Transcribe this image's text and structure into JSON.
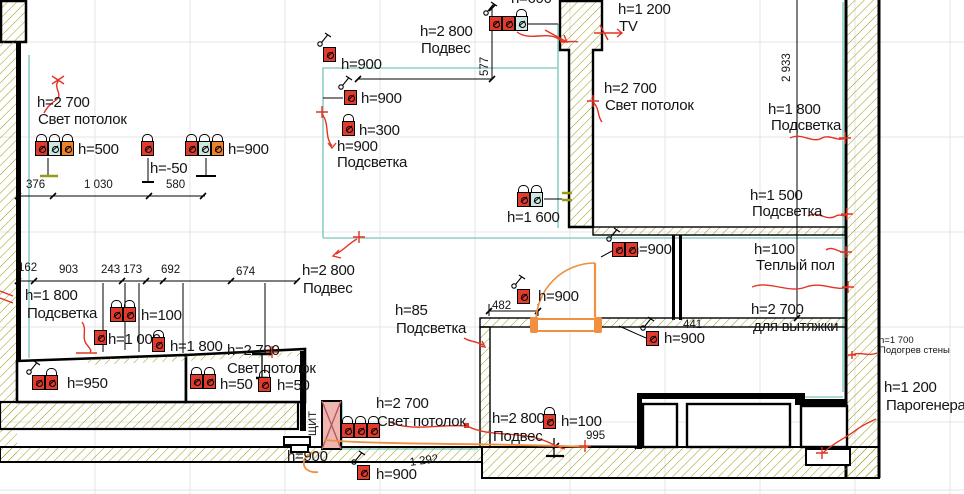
{
  "drawing_type": "electrical outlet height plan fragment",
  "colors": {
    "outletRed": "#e23b2e",
    "cellTeal": "#cfe7e1",
    "cellOrange": "#ee8227",
    "tealLine": "#8ecfc6",
    "hatch": "#9a9b12",
    "markupRed": "#e23323",
    "doorOrange": "#ef8f3f",
    "panelPink": "#efb6b0",
    "panelX": "#b2595c",
    "grid": "#e4e4e4",
    "ink": "#151515"
  },
  "annotations": {
    "labels": [
      {
        "id": "height-ceiling-light-topleft",
        "text": "h=2 700",
        "x": 37,
        "y": 95
      },
      {
        "id": "name-ceiling-light-topleft",
        "text": "Свет потолок",
        "x": 38,
        "y": 112
      },
      {
        "id": "height-500",
        "text": "h=500",
        "x": 78,
        "y": 142
      },
      {
        "id": "height-minus-50",
        "text": "h=-50",
        "x": 150,
        "y": 161
      },
      {
        "id": "height-900-topleft",
        "text": "h=900",
        "x": 228,
        "y": 142
      },
      {
        "id": "dim-376",
        "text": "376",
        "x": 26,
        "y": 179,
        "fs": 11.5
      },
      {
        "id": "dim-1030",
        "text": "1 030",
        "x": 84,
        "y": 179,
        "fs": 11.5
      },
      {
        "id": "dim-580",
        "text": "580",
        "x": 166,
        "y": 179,
        "fs": 11.5
      },
      {
        "id": "height-900-a",
        "text": "h=900",
        "x": 341,
        "y": 57
      },
      {
        "id": "height-900-b",
        "text": "h=900",
        "x": 361,
        "y": 91
      },
      {
        "id": "height-300",
        "text": "h=300",
        "x": 359,
        "y": 123
      },
      {
        "id": "height-900-c",
        "text": "h=900",
        "x": 337,
        "y": 139
      },
      {
        "id": "name-podsvetka-a",
        "text": "Подсветка",
        "x": 337,
        "y": 155
      },
      {
        "id": "height-2800-top",
        "text": "h=2 800",
        "x": 420,
        "y": 24
      },
      {
        "id": "name-podves-top",
        "text": "Подвес",
        "x": 421,
        "y": 41
      },
      {
        "id": "dim-577",
        "text": "577",
        "x": 479,
        "y": 76,
        "fs": 11.5,
        "rot": -90
      },
      {
        "id": "height-600-clipped",
        "text": "h=600",
        "x": 511,
        "y": -9
      },
      {
        "id": "height-1200-tv",
        "text": "h=1 200",
        "x": 618,
        "y": 2
      },
      {
        "id": "name-tv",
        "text": "TV",
        "x": 619,
        "y": 19
      },
      {
        "id": "height-2700-topright",
        "text": "h=2 700",
        "x": 604,
        "y": 81
      },
      {
        "id": "name-ceiling-light-topright",
        "text": "Свет потолок",
        "x": 605,
        "y": 98
      },
      {
        "id": "dim-2933",
        "text": "2 933",
        "x": 781,
        "y": 82,
        "fs": 11.5,
        "rot": -90
      },
      {
        "id": "height-1800-right",
        "text": "h=1 800",
        "x": 768,
        "y": 102
      },
      {
        "id": "name-podsvetka-right",
        "text": "Подсветка",
        "x": 771,
        "y": 118
      },
      {
        "id": "height-1500",
        "text": "h=1 500",
        "x": 750,
        "y": 188
      },
      {
        "id": "name-podsvetka-right2",
        "text": "Подсветка",
        "x": 752,
        "y": 204
      },
      {
        "id": "height-1600",
        "text": "h=1 600",
        "x": 507,
        "y": 210
      },
      {
        "id": "height-900-mid",
        "text": "h=900",
        "x": 631,
        "y": 242
      },
      {
        "id": "height-100-floor",
        "text": "h=100",
        "x": 754,
        "y": 242
      },
      {
        "id": "name-teply-pol",
        "text": "Теплый пол",
        "x": 756,
        "y": 258
      },
      {
        "id": "height-2700-hood",
        "text": "h=2 700",
        "x": 751,
        "y": 302
      },
      {
        "id": "name-dlya-vytyazhki",
        "text": "для вытяжки",
        "x": 753,
        "y": 319
      },
      {
        "id": "height-2800-mid",
        "text": "h=2 800",
        "x": 302,
        "y": 263
      },
      {
        "id": "name-podves-mid",
        "text": "Подвес",
        "x": 303,
        "y": 281
      },
      {
        "id": "height-85",
        "text": "h=85",
        "x": 395,
        "y": 303
      },
      {
        "id": "name-podsvetka-mid",
        "text": "Подсветка",
        "x": 396,
        "y": 321
      },
      {
        "id": "dim-482",
        "text": "482",
        "x": 492,
        "y": 300,
        "fs": 11.5
      },
      {
        "id": "height-900-door",
        "text": "h=900",
        "x": 538,
        "y": 289
      },
      {
        "id": "dim-441",
        "text": "441",
        "x": 683,
        "y": 319,
        "fs": 11.5
      },
      {
        "id": "height-900-441",
        "text": "h=900",
        "x": 664,
        "y": 331
      },
      {
        "id": "height-1700-small",
        "text": "h=1 700",
        "x": 879,
        "y": 336,
        "fs": 9.5
      },
      {
        "id": "name-podogrev-steny",
        "text": "Подогрев стены",
        "x": 879,
        "y": 346,
        "fs": 9.5
      },
      {
        "id": "height-1200-steam",
        "text": "h=1 200",
        "x": 884,
        "y": 380
      },
      {
        "id": "name-parogenerator",
        "text": "Парогенератор",
        "x": 886,
        "y": 398
      },
      {
        "id": "dim-162",
        "text": "162",
        "x": 18,
        "y": 262,
        "fs": 11.5
      },
      {
        "id": "dim-903",
        "text": "903",
        "x": 59,
        "y": 264,
        "fs": 11.5
      },
      {
        "id": "dim-243",
        "text": "243",
        "x": 101,
        "y": 264,
        "fs": 11.5
      },
      {
        "id": "dim-173",
        "text": "173",
        "x": 123,
        "y": 264,
        "fs": 11.5
      },
      {
        "id": "dim-692",
        "text": "692",
        "x": 161,
        "y": 264,
        "fs": 11.5
      },
      {
        "id": "dim-674",
        "text": "674",
        "x": 236,
        "y": 266,
        "fs": 11.5
      },
      {
        "id": "height-1800-kitchenleft",
        "text": "h=1 800",
        "x": 25,
        "y": 288
      },
      {
        "id": "name-podsvetka-kitchenleft",
        "text": "Подсветка",
        "x": 27,
        "y": 306
      },
      {
        "id": "height-100-kitchen",
        "text": "h=100",
        "x": 141,
        "y": 308
      },
      {
        "id": "height-1000",
        "text": "h=1 000",
        "x": 108,
        "y": 332
      },
      {
        "id": "height-1800-kitchen2",
        "text": "h=1 800",
        "x": 170,
        "y": 339
      },
      {
        "id": "height-2700-kitchen",
        "text": "h=2 700",
        "x": 227,
        "y": 343
      },
      {
        "id": "name-ceiling-light-kitchen",
        "text": "Свет потолок",
        "x": 227,
        "y": 361
      },
      {
        "id": "height-950",
        "text": "h=950",
        "x": 67,
        "y": 376
      },
      {
        "id": "height-50-a",
        "text": "h=50",
        "x": 220,
        "y": 377
      },
      {
        "id": "height-50-b",
        "text": "h=50",
        "x": 277,
        "y": 378
      },
      {
        "id": "height-900-bottomleft",
        "text": "h=900",
        "x": 287,
        "y": 449
      },
      {
        "id": "name-shield",
        "text": "ЩИТ",
        "x": 308,
        "y": 436,
        "fs": 11,
        "rot": -90
      },
      {
        "id": "height-2700-bottommid",
        "text": "h=2 700",
        "x": 376,
        "y": 396
      },
      {
        "id": "name-ceiling-light-bottommid",
        "text": "Свет потолок",
        "x": 377,
        "y": 414
      },
      {
        "id": "height-2800-bottommid",
        "text": "h=2 800",
        "x": 492,
        "y": 411
      },
      {
        "id": "name-podves-bottommid",
        "text": "Подвес",
        "x": 493,
        "y": 429
      },
      {
        "id": "height-100-bottommid",
        "text": "h=100",
        "x": 561,
        "y": 414
      },
      {
        "id": "dim-995",
        "text": "995",
        "x": 586,
        "y": 430,
        "fs": 11.5
      },
      {
        "id": "dim-1292",
        "text": "1 292",
        "x": 409,
        "y": 457,
        "fs": 11.5,
        "rot": -8
      },
      {
        "id": "height-900-bottommid",
        "text": "h=900",
        "x": 376,
        "y": 467
      }
    ],
    "outlets": [
      {
        "id": "outlet-group-500",
        "x": 35,
        "y": 141,
        "cells": [
          "red",
          "teal",
          "orange"
        ],
        "hats": 3
      },
      {
        "id": "outlet-minus50",
        "x": 141,
        "y": 141,
        "cells": [
          "red"
        ],
        "hats": 1
      },
      {
        "id": "outlet-group-900-topleft",
        "x": 185,
        "y": 141,
        "cells": [
          "red",
          "teal",
          "orange"
        ],
        "hats": 3
      },
      {
        "id": "outlet-900-a",
        "x": 323,
        "y": 47,
        "cells": [
          "red"
        ],
        "sw": true
      },
      {
        "id": "outlet-900-b",
        "x": 344,
        "y": 90,
        "cells": [
          "red"
        ],
        "sw": true
      },
      {
        "id": "outlet-300",
        "x": 342,
        "y": 121,
        "cells": [
          "red"
        ],
        "hats": 1
      },
      {
        "id": "outlet-group-600-top",
        "x": 489,
        "y": 16,
        "cells": [
          "red",
          "red",
          "teal"
        ],
        "hats": 1,
        "sw": true
      },
      {
        "id": "outlet-group-1600",
        "x": 517,
        "y": 192,
        "cells": [
          "red",
          "teal"
        ],
        "hats": 2
      },
      {
        "id": "outlet-900-mid",
        "x": 612,
        "y": 242,
        "cells": [
          "red",
          "red"
        ],
        "sw": true
      },
      {
        "id": "outlet-900-door",
        "x": 517,
        "y": 289,
        "cells": [
          "red"
        ],
        "sw": true
      },
      {
        "id": "outlet-900-441",
        "x": 646,
        "y": 331,
        "cells": [
          "red"
        ],
        "sw": true
      },
      {
        "id": "outlet-group-950",
        "x": 32,
        "y": 375,
        "cells": [
          "red",
          "red"
        ],
        "hats": 1,
        "sw": true
      },
      {
        "id": "outlet-group-50",
        "x": 190,
        "y": 374,
        "cells": [
          "red",
          "red"
        ],
        "hats": 2
      },
      {
        "id": "outlet-50-single",
        "x": 258,
        "y": 377,
        "cells": [
          "red"
        ],
        "hats": 1
      },
      {
        "id": "outlet-group-100-kitchen",
        "x": 110,
        "y": 307,
        "cells": [
          "red",
          "red"
        ],
        "hats": 2
      },
      {
        "id": "outlet-1000",
        "x": 94,
        "y": 330,
        "cells": [
          "red"
        ]
      },
      {
        "id": "outlet-1800-kitchen",
        "x": 152,
        "y": 337,
        "cells": [
          "red"
        ],
        "hats": 1
      },
      {
        "id": "outlet-100-bottommid",
        "x": 543,
        "y": 414,
        "cells": [
          "red"
        ],
        "hats": 1
      },
      {
        "id": "outlet-900-bottom",
        "x": 357,
        "y": 465,
        "cells": [
          "red"
        ],
        "sw": true
      },
      {
        "id": "outlet-group-panel",
        "x": 341,
        "y": 423,
        "cells": [
          "red",
          "red",
          "red"
        ],
        "hats": 3
      }
    ]
  }
}
